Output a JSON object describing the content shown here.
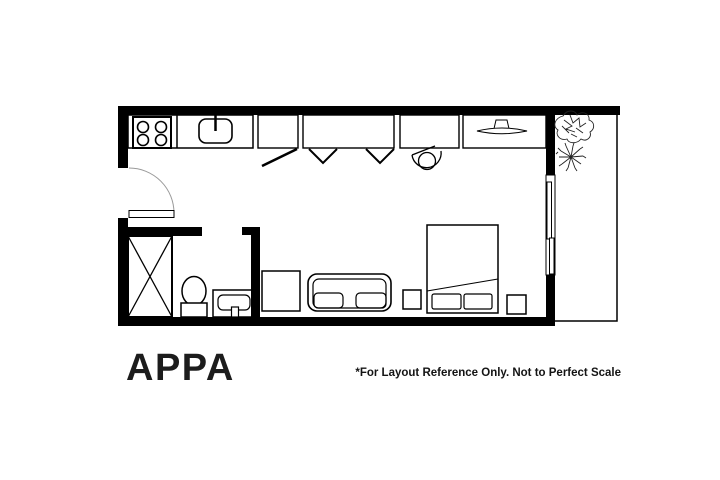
{
  "page": {
    "background_color": "#ffffff",
    "line_color": "#000000",
    "title": "APPA",
    "disclaimer": "*For Layout Reference Only. Not to Perfect Scale"
  },
  "floor_plan": {
    "kind": "studio-apartment-floor-plan",
    "fixtures": [
      "entry-door",
      "kitchen-counter",
      "stove-burners",
      "kitchen-sink",
      "hinged-door-closet",
      "bifold-door-closet",
      "pivot-door-closet",
      "wall-tv",
      "sliding-glass-door",
      "balcony",
      "leafy-plant",
      "spiky-plant",
      "shower",
      "toilet",
      "vanity-sink",
      "armchair-square",
      "sofa",
      "left-nightstand",
      "right-nightstand",
      "double-bed",
      "pillows"
    ]
  }
}
